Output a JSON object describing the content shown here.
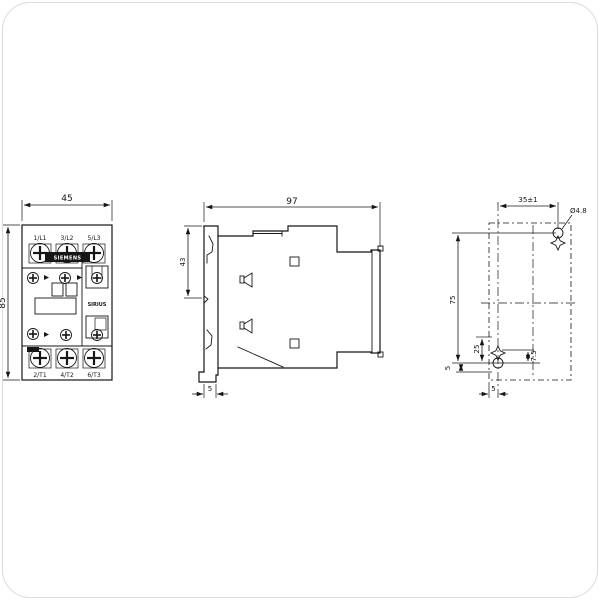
{
  "front_view": {
    "dim_width": "45",
    "dim_height": "85",
    "brand": "SIEMENS",
    "series_label": "SIRIUS",
    "terminals_top": [
      "1/L1",
      "3/L2",
      "5/L3"
    ],
    "terminals_bottom": [
      "2/T1",
      "4/T2",
      "6/T3"
    ]
  },
  "side_view": {
    "dim_depth": "97",
    "dim_rail": "43",
    "dim_foot": "5"
  },
  "drill_plan": {
    "dim_hole_spacing_horizontal": "35±1",
    "dim_hole_diameter": "Ø4.8",
    "dim_hole_spacing_vertical": "75",
    "dim_offset_25": "25",
    "dim_offset_7_5": "7.5",
    "dim_offset_5_left": "5",
    "dim_edge_5_bottom": "5"
  }
}
